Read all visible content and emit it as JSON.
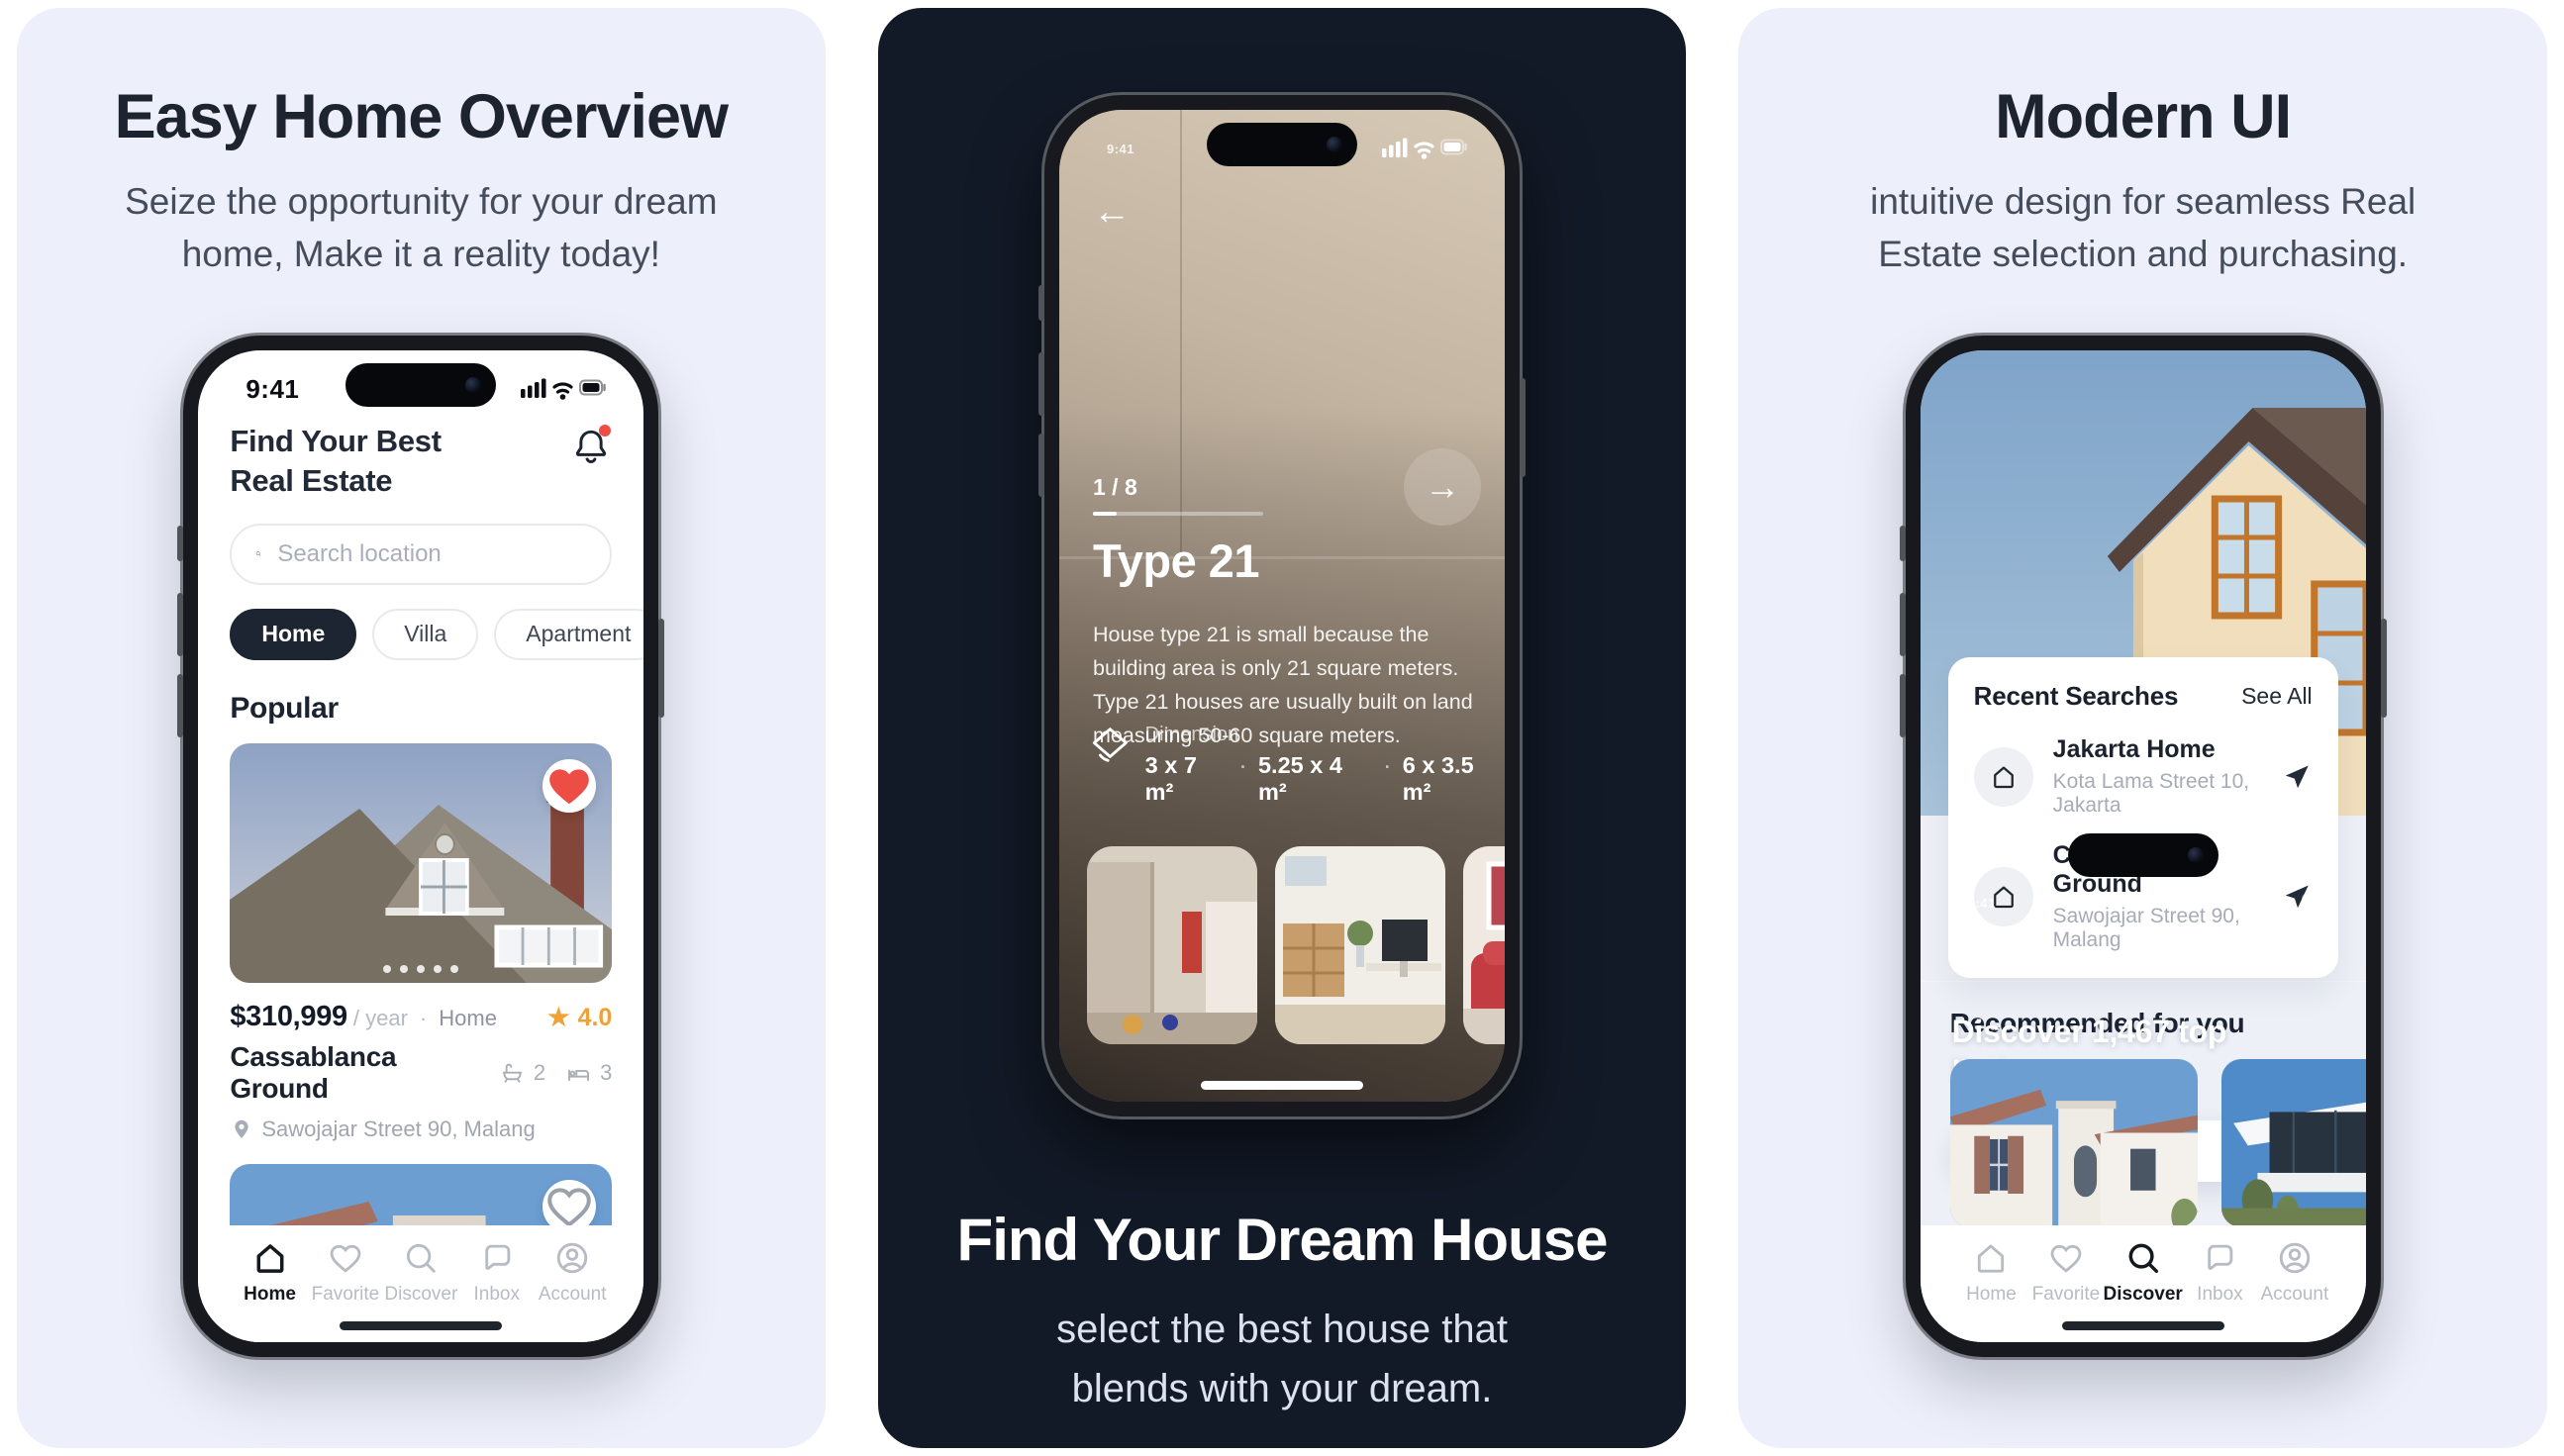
{
  "panel_left": {
    "title": "Easy Home Overview",
    "subtitle_line1": "Seize the opportunity for your dream",
    "subtitle_line2": "home, Make it a reality today!"
  },
  "panel_middle": {
    "title": "Find Your Dream House",
    "subtitle_line1": "select the best house that",
    "subtitle_line2": "blends with your dream."
  },
  "panel_right": {
    "title": "Modern UI",
    "subtitle_line1": "intuitive design for seamless Real",
    "subtitle_line2": "Estate selection and purchasing."
  },
  "phone_home": {
    "time": "9:41",
    "title_line1": "Find Your Best",
    "title_line2": "Real Estate",
    "search_placeholder": "Search location",
    "chips": [
      {
        "label": "Home"
      },
      {
        "label": "Villa"
      },
      {
        "label": "Apartment"
      }
    ],
    "section_title": "Popular",
    "listing": {
      "price": "$310,999",
      "price_suffix": "/ year",
      "separator": "·",
      "category": "Home",
      "rating_star": "★",
      "rating": "4.0",
      "name": "Cassablanca Ground",
      "bath_count": "2",
      "bed_count": "3",
      "address": "Sawojajar Street 90, Malang"
    },
    "nav": [
      {
        "label": "Home"
      },
      {
        "label": "Favorite"
      },
      {
        "label": "Discover"
      },
      {
        "label": "Inbox"
      },
      {
        "label": "Account"
      }
    ]
  },
  "phone_detail": {
    "time": "9:41",
    "back_arrow": "←",
    "counter": "1 / 8",
    "next_arrow": "→",
    "title": "Type 21",
    "description": "House type 21 is small because the building area is only 21 square meters. Type 21 houses are usually built on land measuring 50-60 square meters.",
    "dimension_label": "Dimension",
    "dim1": "3 x 7 m²",
    "dim2": "5.25 x 4 m²",
    "dim3": "6 x 3.5 m²",
    "dim_sep": "·"
  },
  "phone_discover": {
    "time": "9:41",
    "back_arrow": "←",
    "header_title": "Discover",
    "hero_line1": "Discover 1,467 top",
    "hero_line2": "listings",
    "search_placeholder": "Search location",
    "recent_title": "Recent Searches",
    "see_all": "See All",
    "recent": [
      {
        "name": "Jakarta Home",
        "address": "Kota Lama Street 10, Jakarta"
      },
      {
        "name": "Cassablanca Ground",
        "address": "Sawojajar Street 90, Malang"
      }
    ],
    "recommended_title": "Recommended for you",
    "recommended": [
      {
        "price": "$110,444",
        "suffix": "/ year",
        "separator": "·",
        "category": "Apartment",
        "name": "Swiss Apartment"
      },
      {
        "price": "$310,999",
        "suffix": "/ year",
        "separator": "·",
        "category": "",
        "name": "Java Paris Maiso"
      }
    ],
    "nav": [
      {
        "label": "Home"
      },
      {
        "label": "Favorite"
      },
      {
        "label": "Discover"
      },
      {
        "label": "Inbox"
      },
      {
        "label": "Account"
      }
    ]
  },
  "icons": {
    "bell": "notification-bell",
    "search": "magnifier",
    "heart": "heart",
    "home": "house",
    "chat": "speech-bubble",
    "person": "avatar-circle",
    "pin": "location-pin",
    "bath": "bathtub",
    "bed": "bed",
    "send": "navigation-arrow",
    "dimension": "diamond-tag",
    "star": "★"
  },
  "colors": {
    "panel_light_bg": "#edf0fa",
    "panel_dark_bg": "#131a27",
    "heading_dark": "#1d2430",
    "chip_active_bg": "#1d2533",
    "rating_orange": "#efa13a",
    "heart_red": "#ee4d45",
    "muted_gray": "#a6acb6"
  }
}
